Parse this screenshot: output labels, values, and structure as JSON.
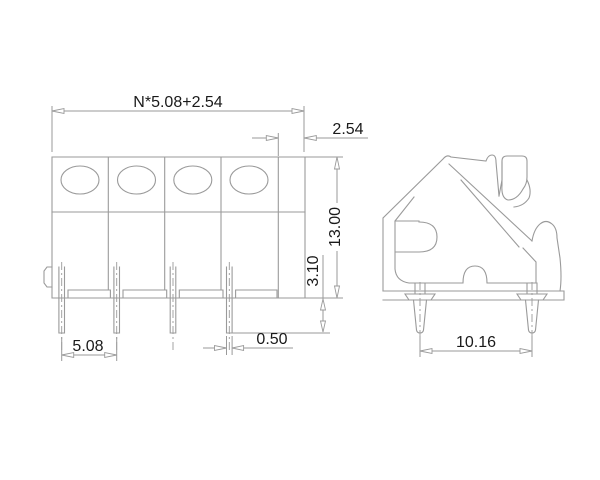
{
  "drawing": {
    "colors": {
      "background": "#ffffff",
      "line": "#9a9a9a",
      "text": "#1a1a1a"
    },
    "dimensions": {
      "total_width": "N*5.08+2.54",
      "end_margin": "2.54",
      "body_height": "13.00",
      "standoff": "3.10",
      "pin_pitch": "5.08",
      "pin_width": "0.50",
      "side_pin_span": "10.16"
    }
  }
}
